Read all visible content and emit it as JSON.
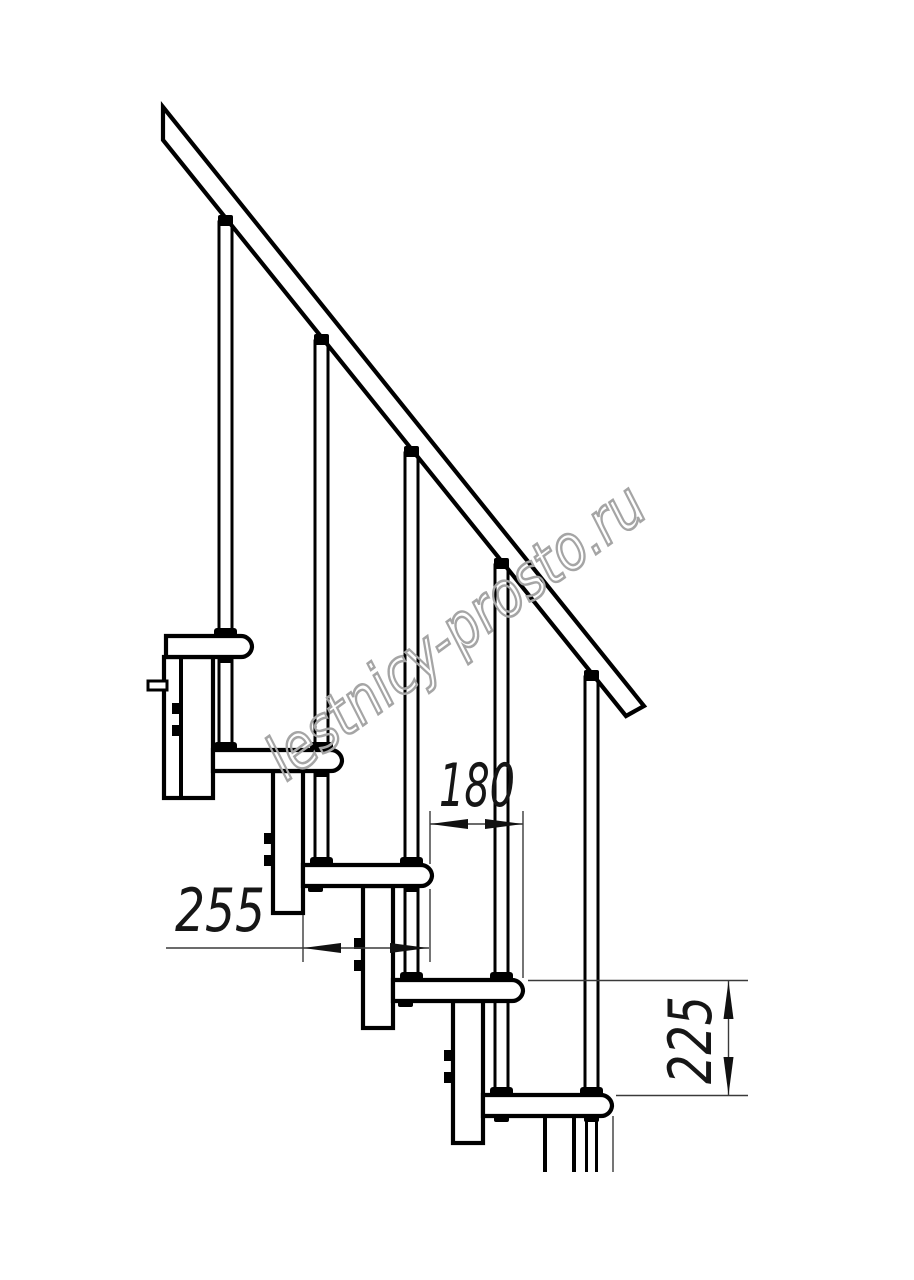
{
  "watermark": {
    "text": "lestnicy-prosto.ru"
  },
  "dimensions": {
    "tread_depth": "255",
    "tread_run": "180",
    "riser_height": "225"
  }
}
